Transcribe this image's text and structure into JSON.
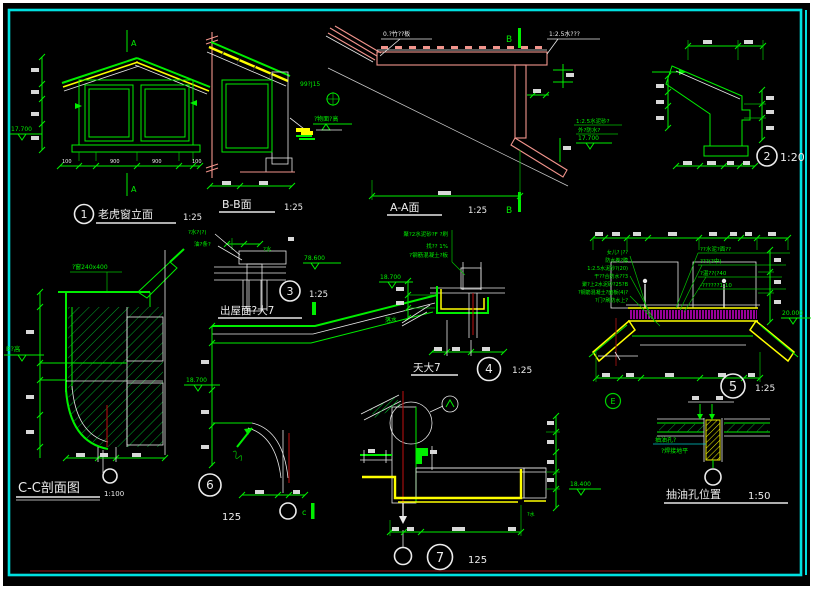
{
  "sheet": {
    "background": "#000000",
    "frame_color": "#00e0e0",
    "paper_color": "#ffffff",
    "line_colors": {
      "green": "#00ee00",
      "yellow": "#ffff00",
      "salmon": "#f2948c",
      "magenta": "#ff00ff",
      "red": "#b01010",
      "white": "#ececec"
    }
  },
  "dormer": {
    "num": "1",
    "title": "老虎窗立面",
    "scale": "1:25",
    "marker_top": "A",
    "marker_bottom": "A",
    "level": "17.700",
    "dims": [
      "100",
      "900",
      "900",
      "100"
    ]
  },
  "bb": {
    "title": "B-B面",
    "scale": "1:25"
  },
  "aa": {
    "title": "A-A面",
    "scale": "1:25",
    "marker_top": "B",
    "marker_bottom": "B",
    "note_board": "0.?竹??板",
    "note_mortar": "1:2.5水???",
    "note_plate": "99?J15",
    "note_level": "?物面?高"
  },
  "d2": {
    "num": "2",
    "scale": "1:20",
    "note1": "1:2.5水泥砂?",
    "note2": "外?防水?",
    "level": "17.700"
  },
  "d3": {
    "num": "3",
    "scale": "1:25",
    "title": "出屋面?大7",
    "note1": "?水?(?)",
    "note2": "油?条?",
    "note3": "?水",
    "level": "78.600"
  },
  "cc": {
    "title": "C-C剖面图",
    "scale": "1:100",
    "note_window": "?窗240x400",
    "note_b": "B?高",
    "level": "18.700"
  },
  "d6": {
    "num": "6",
    "scale": "125",
    "marker": "c"
  },
  "d4": {
    "num": "4",
    "scale": "1:25",
    "title": "天大7",
    "level": "18.700",
    "note1": "聚?2水泥砂?F ?刷",
    "note2": "找?? 1%",
    "note3": "?钢筋混凝土?板",
    "note4": "落水"
  },
  "d5": {
    "num": "5",
    "scale": "1:25",
    "level": "20.000",
    "marker": "E",
    "notes_left": [
      "女儿? |??",
      "防水卷?膜",
      "1:2.5水泥砂?(20)",
      "干??合防水??3",
      "聚?上2水泥砂?25?B",
      "?钢筋混凝土?面板(4)?",
      "?门?刷防水上?"
    ],
    "notes_right": [
      "??水泥?面??",
      "???(?中)",
      "?温??(?40",
      "-??????1:10"
    ]
  },
  "d7": {
    "num": "7",
    "scale": "125",
    "level": "18.400",
    "note": "?水"
  },
  "oil": {
    "title": "抽油孔位置",
    "scale": "1:50",
    "note1": "抽油孔?",
    "note2": "?焊接地平"
  }
}
